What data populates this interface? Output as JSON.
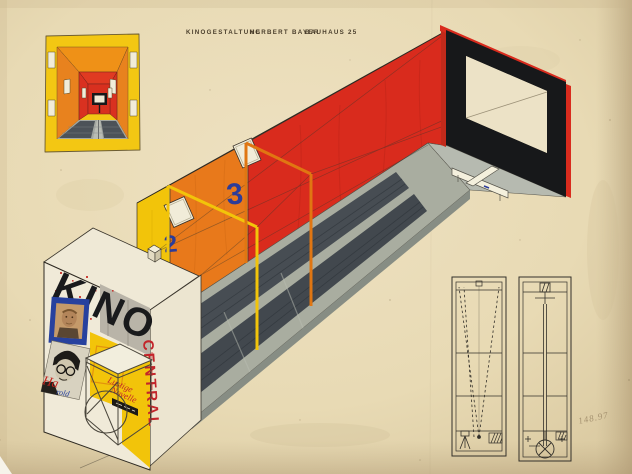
{
  "artwork": {
    "inscription": {
      "part1": "KINOGESTALTUNG",
      "part2": "HERBERT BAYER",
      "part3": "BAUHAUS 25"
    },
    "axonometric": {
      "section_label_2": "2",
      "section_label_3": "3",
      "facade": {
        "sign": "KINO",
        "cinema_name_vertical": "CENTRAL",
        "poster_caption_red": "Ha",
        "poster_caption_blue": "rold",
        "marquee_script_line1": "Lustige",
        "marquee_script_line2": "Novelle"
      }
    },
    "pencil_note": "148.97",
    "colors": {
      "paper": "#e9dcba",
      "yellow": "#f2c40a",
      "orange": "#e8791b",
      "red": "#d92b1d",
      "blue_accent": "#2c3c99",
      "black": "#1a1a1c",
      "floor_dark": "#474d53",
      "floor_light": "#a9ada0",
      "sign_red": "#c3242a"
    }
  }
}
